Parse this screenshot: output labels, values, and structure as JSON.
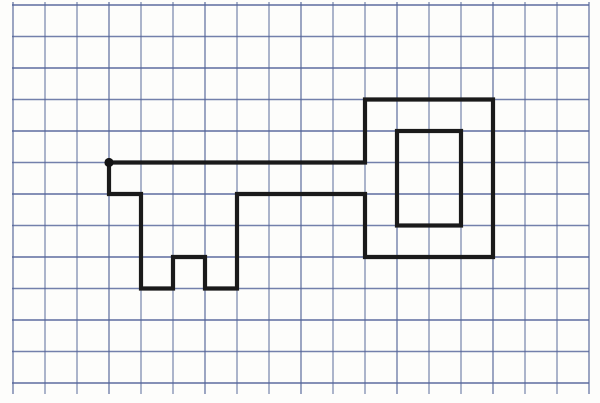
{
  "figure": {
    "title": "",
    "canvas": {
      "width": 600,
      "height": 403,
      "background_color": "#fdfdfb"
    },
    "grid": {
      "vertical_line_color": "#6b7aa6",
      "horizontal_line_color": "#55659a",
      "stroke_width": 1.4,
      "columns": 19,
      "rows": 13,
      "x0": 13,
      "y0": 5,
      "x_spacing": 32,
      "y_spacing": 31.5,
      "horizontal_extent": [
        12,
        589
      ],
      "vertical_extent": [
        2,
        394
      ]
    },
    "key_shape": {
      "line_color": "#1a1a1a",
      "stroke_width": 4.2,
      "outline_points_grid": [
        [
          3,
          5
        ],
        [
          3,
          6
        ],
        [
          4,
          6
        ],
        [
          4,
          9
        ],
        [
          5,
          9
        ],
        [
          5,
          8
        ],
        [
          6,
          8
        ],
        [
          6,
          9
        ],
        [
          7,
          9
        ],
        [
          7,
          6
        ],
        [
          11,
          6
        ],
        [
          11,
          8
        ],
        [
          15,
          8
        ],
        [
          15,
          3
        ],
        [
          11,
          3
        ],
        [
          11,
          5
        ]
      ],
      "outline_closed": true,
      "inner_rectangle_grid": {
        "col1": 12,
        "row1": 4,
        "col2": 14,
        "row2": 7
      },
      "start_dot_grid": [
        3,
        5
      ],
      "start_dot_radius": 4.6,
      "start_dot_color": "#141414"
    }
  }
}
